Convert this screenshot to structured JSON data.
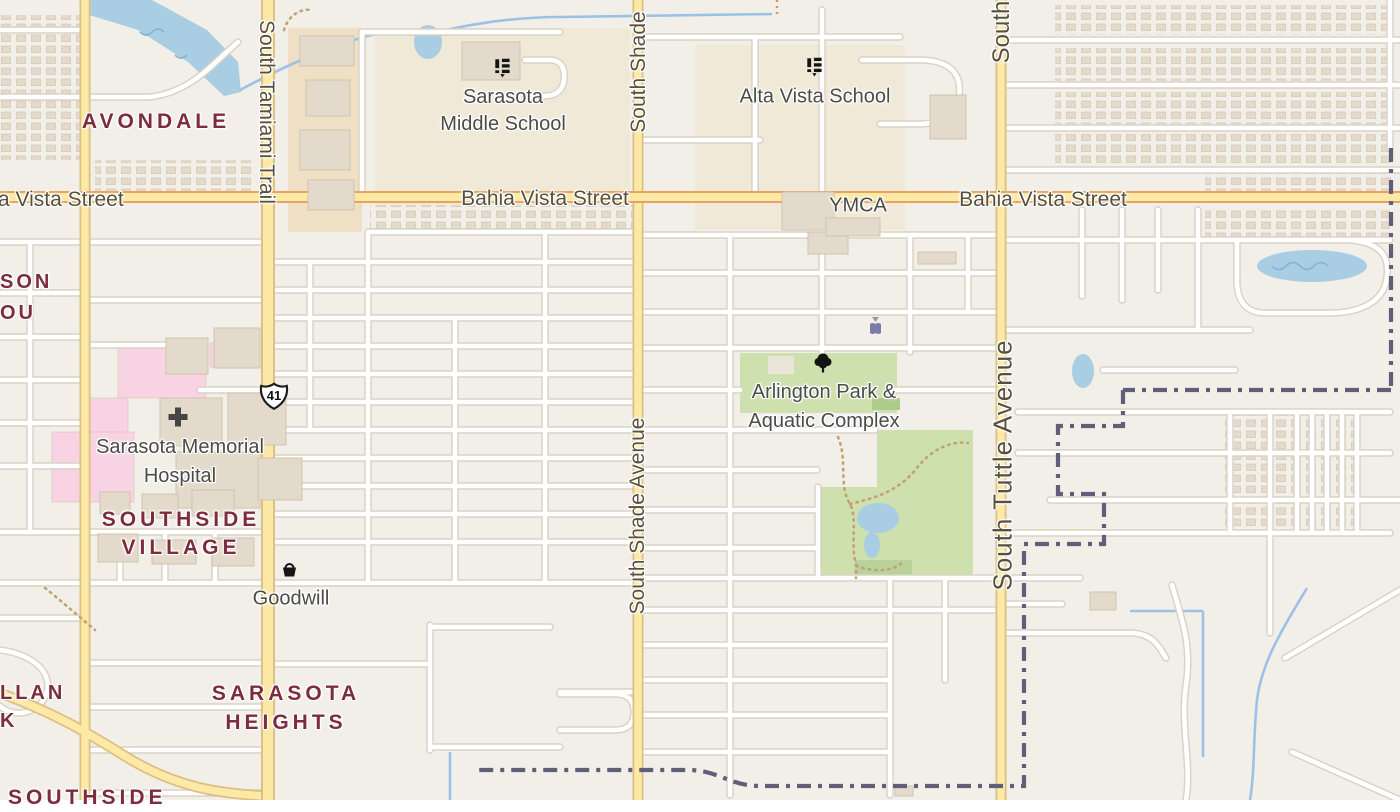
{
  "map": {
    "colors": {
      "bg": "#f2efe9",
      "road_fill": "#ffffff",
      "road_casing": "#d9d2c5",
      "yellow_fill": "#fce9a5",
      "yellow_casing": "#dcbf83",
      "orange_casing": "#e7a35f",
      "water": "#a9cde3",
      "water_line": "#9cc1e6",
      "park": "#cde0ae",
      "park_dark": "#aecb8b",
      "scrub": "#b9d29a",
      "hospital_pink": "#f8d3e3",
      "school_ground": "#f1e9d7",
      "retail": "#efe0c5",
      "building": "#e4dacb",
      "building_stroke": "#cfc3ae",
      "boundary": "#5f5f78",
      "path_dots": "#c0a276",
      "label_street": "#57503f",
      "label_poi": "#4b4b47",
      "label_neighborhood": "#7d2c3d",
      "icon_black": "#141414",
      "poi_purple": "#7b7da8"
    },
    "neighborhoods": {
      "avondale": "AVONDALE",
      "village_l1": "SOUTHSIDE",
      "village_l2": "VILLAGE",
      "heights_l1": "SARASOTA",
      "heights_l2": "HEIGHTS",
      "son": "SON",
      "ou": "OU",
      "llan": "LLAN",
      "k": "K",
      "southside": "SOUTHSIDE"
    },
    "streets": {
      "bahia_left": "a Vista Street",
      "bahia_center": "Bahia Vista Street",
      "bahia_right": "Bahia Vista Street",
      "tamiami": "South Tamiami Trail",
      "shade_top": "South Shade",
      "shade": "South Shade Avenue",
      "tuttle_top": "South",
      "tuttle": "South Tuttle Avenue"
    },
    "pois": {
      "ms_l1": "Sarasota",
      "ms_l2": "Middle School",
      "alta": "Alta Vista School",
      "ymca": "YMCA",
      "goodwill": "Goodwill",
      "hosp_l1": "Sarasota Memorial",
      "hosp_l2": "Hospital",
      "arl_l1": "Arlington Park &",
      "arl_l2": "Aquatic Complex"
    },
    "shield": {
      "route": "41"
    },
    "icon_names": [
      "school-icon",
      "tree-icon",
      "shopping-basket-icon",
      "hospital-cross-icon",
      "us-route-shield",
      "poi-book-icon"
    ]
  }
}
